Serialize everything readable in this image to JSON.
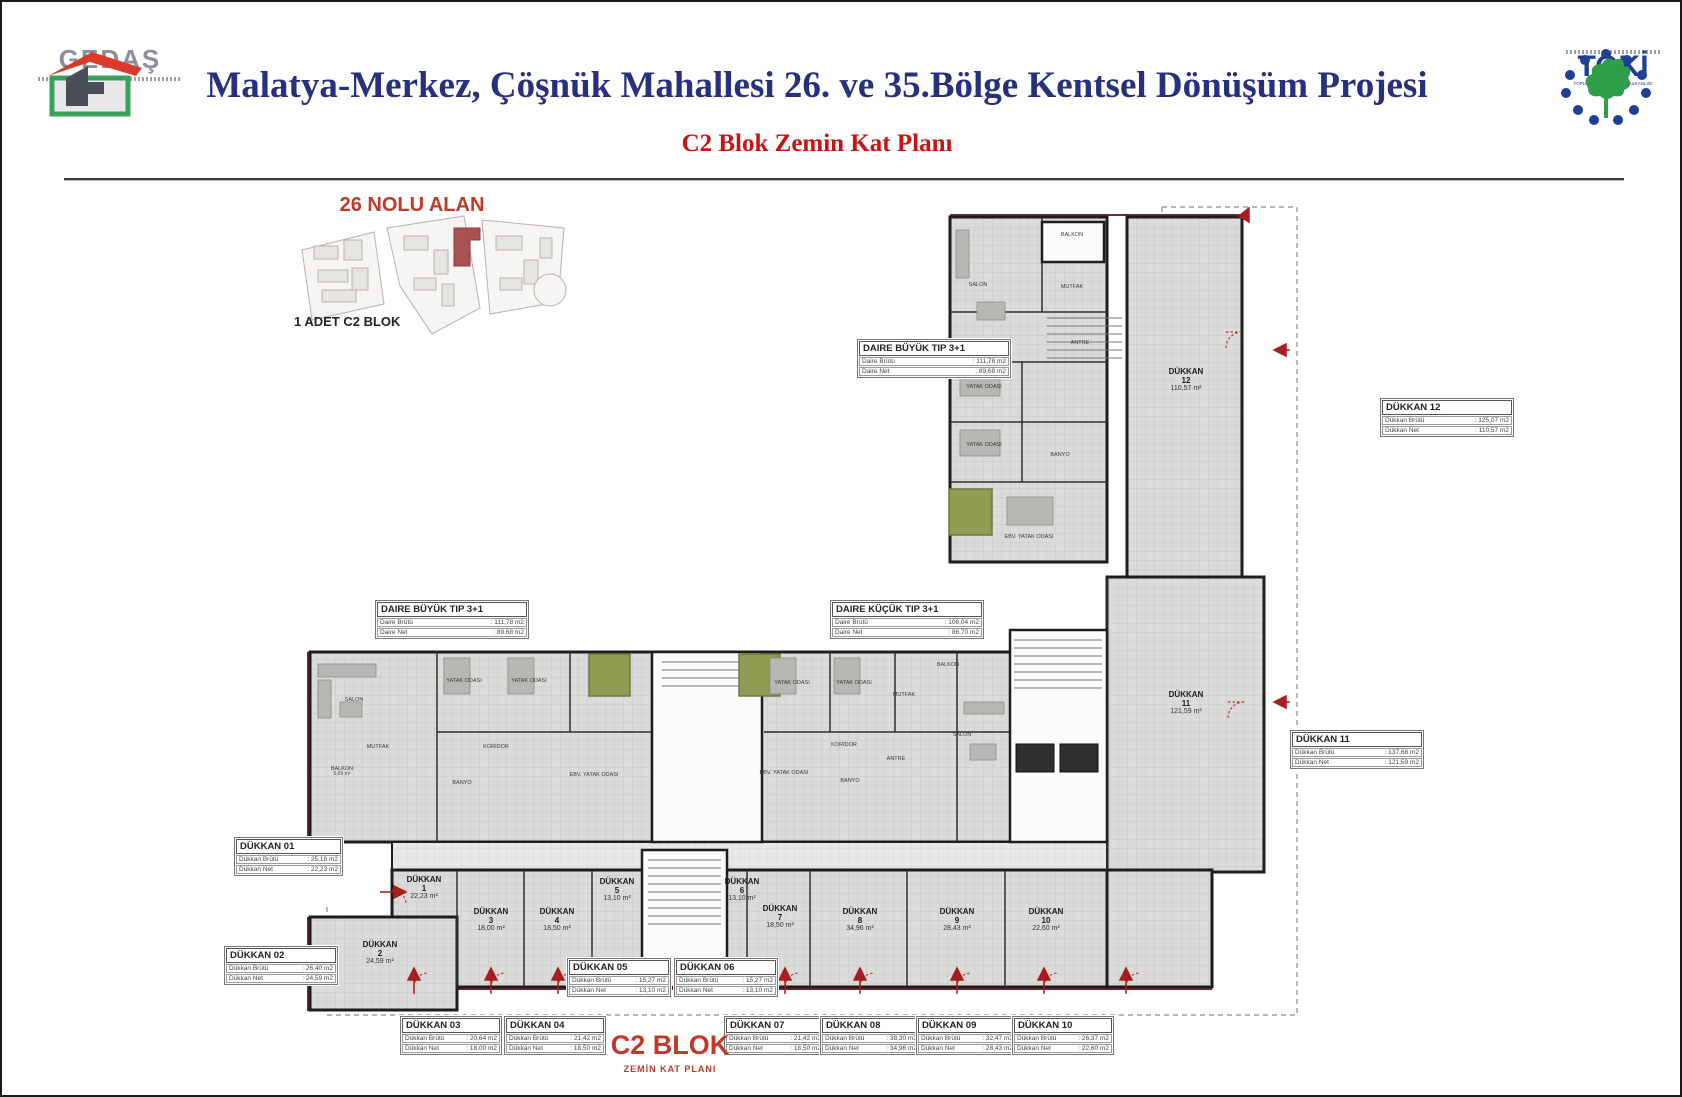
{
  "header": {
    "title": "Malatya-Merkez, Çöşnük Mahallesi 26. ve 35.Bölge Kentsel Dönüşüm Projesi",
    "subtitle": "C2 Blok Zemin Kat Planı",
    "gedas_name": "GEDAŞ",
    "toki_name": "TOKİ",
    "toki_tagline": "TOPLU KONUT İDARESİ BAŞKANLIĞI"
  },
  "site_inset": {
    "title": "26 NOLU ALAN",
    "caption": "1 ADET C2 BLOK"
  },
  "footer": {
    "block_title": "C2 BLOK",
    "block_subtitle": "ZEMİN KAT PLANI"
  },
  "colors": {
    "title_blue": "#26307e",
    "accent_red": "#c0392b",
    "maroon": "#7e2433",
    "olive": "#8f9b52"
  },
  "plan": {
    "shops": [
      {
        "label": "DÜKKAN",
        "num": "1",
        "area": "22,23 m²"
      },
      {
        "label": "DÜKKAN",
        "num": "2",
        "area": "24,59 m²"
      },
      {
        "label": "DÜKKAN",
        "num": "3",
        "area": "18,00 m²"
      },
      {
        "label": "DÜKKAN",
        "num": "4",
        "area": "18,50 m²"
      },
      {
        "label": "DÜKKAN",
        "num": "5",
        "area": "13,10 m²"
      },
      {
        "label": "DÜKKAN",
        "num": "6",
        "area": "13,10 m²"
      },
      {
        "label": "DÜKKAN",
        "num": "7",
        "area": "18,50 m²"
      },
      {
        "label": "DÜKKAN",
        "num": "8",
        "area": "34,96 m²"
      },
      {
        "label": "DÜKKAN",
        "num": "9",
        "area": "28,43 m²"
      },
      {
        "label": "DÜKKAN",
        "num": "10",
        "area": "22,60 m²"
      },
      {
        "label": "DÜKKAN",
        "num": "11",
        "area": "121,59 m²"
      },
      {
        "label": "DÜKKAN",
        "num": "12",
        "area": "110,57 m²"
      }
    ],
    "rooms": [
      {
        "label": "SALON"
      },
      {
        "label": "BALKON"
      },
      {
        "label": "MUTFAK"
      },
      {
        "label": "ANTRE"
      },
      {
        "label": "YATAK ODASI"
      },
      {
        "label": "YATAK ODASI"
      },
      {
        "label": "BANYO"
      },
      {
        "label": "EBV. YATAK ODASI"
      },
      {
        "label": "SALON"
      },
      {
        "label": "YATAK ODASI"
      },
      {
        "label": "YATAK ODASI"
      },
      {
        "label": "KORİDOR"
      },
      {
        "label": "BALKON",
        "area": "5,69 m²"
      },
      {
        "label": "MUTFAK"
      },
      {
        "label": "BANYO"
      },
      {
        "label": "EBV. YATAK ODASI"
      },
      {
        "label": "YATAK ODASI"
      },
      {
        "label": "YATAK ODASI"
      },
      {
        "label": "MUTFAK"
      },
      {
        "label": "BALKON"
      },
      {
        "label": "KORİDOR"
      },
      {
        "label": "EBV. YATAK ODASI"
      },
      {
        "label": "BANYO"
      },
      {
        "label": "ANTRE"
      },
      {
        "label": "SALON"
      }
    ]
  },
  "info_boxes": {
    "dbt": {
      "title": "DAIRE BÜYÜK TIP 3+1",
      "rows": [
        {
          "l": "Daire Brütü",
          "v": "111,78 m2"
        },
        {
          "l": "Daire Net",
          "v": "89,68 m2"
        }
      ]
    },
    "dbl": {
      "title": "DAIRE BÜYÜK TIP 3+1",
      "rows": [
        {
          "l": "Daire Brütü",
          "v": "111,78 m2"
        },
        {
          "l": "Daire Net",
          "v": "89,68 m2"
        }
      ]
    },
    "dkc": {
      "title": "DAIRE KÜÇÜK TIP 3+1",
      "rows": [
        {
          "l": "Daire Brütü",
          "v": "106,04 m2"
        },
        {
          "l": "Daire Net",
          "v": "86,70 m2"
        }
      ]
    },
    "d01": {
      "title": "DÜKKAN 01",
      "rows": [
        {
          "l": "Dükkan Brütü",
          "v": "25,18 m2"
        },
        {
          "l": "Dükkan Net",
          "v": "22,23 m2"
        }
      ]
    },
    "d02": {
      "title": "DÜKKAN 02",
      "rows": [
        {
          "l": "Dükkan Brütü",
          "v": "26,40 m2"
        },
        {
          "l": "Dükkan Net",
          "v": "24,59 m2"
        }
      ]
    },
    "d03": {
      "title": "DÜKKAN 03",
      "rows": [
        {
          "l": "Dükkan Brütü",
          "v": "20,64 m2"
        },
        {
          "l": "Dükkan Net",
          "v": "18,00 m2"
        }
      ]
    },
    "d04": {
      "title": "DÜKKAN 04",
      "rows": [
        {
          "l": "Dükkan Brütü",
          "v": "21,42 m2"
        },
        {
          "l": "Dükkan Net",
          "v": "18,50 m2"
        }
      ]
    },
    "d05": {
      "title": "DÜKKAN 05",
      "rows": [
        {
          "l": "Dükkan Brütü",
          "v": "15,27 m2"
        },
        {
          "l": "Dükkan Net",
          "v": "13,10 m2"
        }
      ]
    },
    "d06": {
      "title": "DÜKKAN 06",
      "rows": [
        {
          "l": "Dükkan Brütü",
          "v": "15,27 m2"
        },
        {
          "l": "Dükkan Net",
          "v": "13,10 m2"
        }
      ]
    },
    "d07": {
      "title": "DÜKKAN 07",
      "rows": [
        {
          "l": "Dükkan Brütü",
          "v": "21,42 m2"
        },
        {
          "l": "Dükkan Net",
          "v": "18,50 m2"
        }
      ]
    },
    "d08": {
      "title": "DÜKKAN 08",
      "rows": [
        {
          "l": "Dükkan Brütü",
          "v": "38,30 m2"
        },
        {
          "l": "Dükkan Net",
          "v": "34,96 m2"
        }
      ]
    },
    "d09": {
      "title": "DÜKKAN 09",
      "rows": [
        {
          "l": "Dükkan Brütü",
          "v": "32,47 m2"
        },
        {
          "l": "Dükkan Net",
          "v": "28,43 m2"
        }
      ]
    },
    "d10": {
      "title": "DÜKKAN 10",
      "rows": [
        {
          "l": "Dükkan Brütü",
          "v": "26,37 m2"
        },
        {
          "l": "Dükkan Net",
          "v": "22,60 m2"
        }
      ]
    },
    "d11": {
      "title": "DÜKKAN 11",
      "rows": [
        {
          "l": "Dükkan Brütü",
          "v": "137,68 m2"
        },
        {
          "l": "Dükkan Net",
          "v": "121,59 m2"
        }
      ]
    },
    "d12": {
      "title": "DÜKKAN 12",
      "rows": [
        {
          "l": "Dükkan Brütü",
          "v": "125,07 m2"
        },
        {
          "l": "Dükkan Net",
          "v": "110,57 m2"
        }
      ]
    }
  }
}
